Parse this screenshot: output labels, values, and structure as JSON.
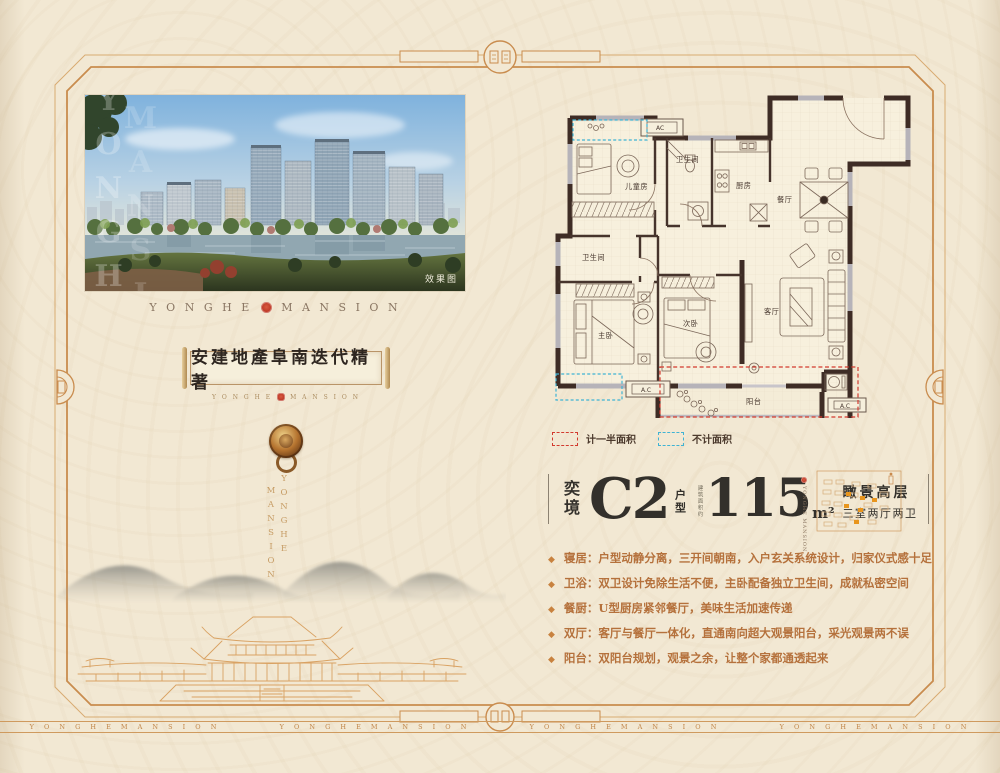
{
  "brand": {
    "wordmark_spaced_left": "Y O N G H E",
    "wordmark_spaced_right": "M A N S I O N",
    "band_item": "Y O N G H E    M A N S I O N",
    "vertical_right": "YONGHE",
    "vertical_left": "MANSION",
    "side_vertical": "YONGHE MANSION"
  },
  "hero": {
    "caption": "效果图",
    "watermark_col1": "YONGHE",
    "watermark_col2": "MANSION"
  },
  "scroll": {
    "calligraphy": "安建地產阜南迭代精著",
    "sub_left": "Y O N G H E",
    "sub_right": "M A N S I O N"
  },
  "floorplan": {
    "rooms": [
      "儿童房",
      "卫生间",
      "厨房",
      "餐厅",
      "卫生间",
      "主卧",
      "次卧",
      "客厅",
      "阳台"
    ],
    "ac_top": "AC",
    "ac_bottom_left": "A.C",
    "ac_bottom_right": "A.C",
    "legend": [
      {
        "color": "#d23a2e",
        "label": "计一半面积"
      },
      {
        "color": "#3fb3d4",
        "label": "不计面积"
      }
    ]
  },
  "title_block": {
    "prefix": "奕境",
    "model": "C2",
    "type_label": "户型",
    "area_note": "建筑面积约",
    "area_value": "115",
    "area_unit": "m²",
    "tag_line1": "瞰景高层",
    "tag_line2": "三室两厅两卫"
  },
  "features": [
    {
      "marker": "◆",
      "label": "寝居：",
      "text": "户型动静分离，三开间朝南，入户玄关系统设计，归家仪式感十足"
    },
    {
      "marker": "◆",
      "label": "卫浴：",
      "text": "双卫设计免除生活不便，主卧配备独立卫生间，成就私密空间"
    },
    {
      "marker": "◆",
      "label": "餐厨：",
      "text": "U型厨房紧邻餐厅，美味生活加速传递"
    },
    {
      "marker": "◆",
      "label": "双厅：",
      "text": "客厅与餐厅一体化，直通南向超大观景阳台，采光观景两不误"
    },
    {
      "marker": "◆",
      "label": "阳台：",
      "text": "双阳台规划，观景之余，让整个家都通透起来"
    }
  ],
  "colors": {
    "page_bg": "#f2e8d3",
    "frame_orange": "#c98c4e",
    "wall_dark": "#3e2c25",
    "wall_gray": "#b6b3b9",
    "half_area_dash": "#d23a2e",
    "no_area_dash": "#3fb3d4",
    "title_ink": "#33302b",
    "feature_orange": "#b5713c",
    "seal_red": "#b93322"
  }
}
